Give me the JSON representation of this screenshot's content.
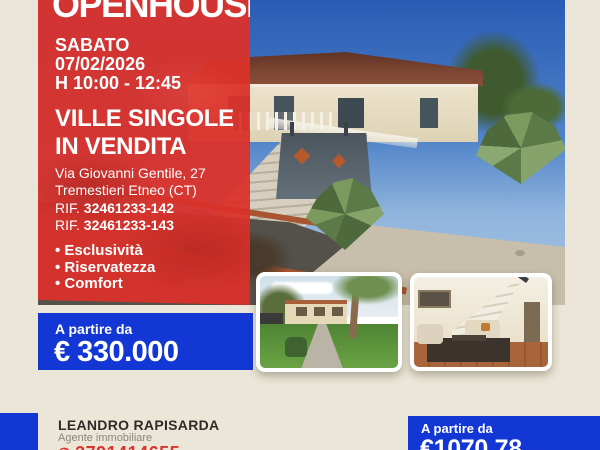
{
  "colors": {
    "accent_red": "#da352c",
    "accent_blue": "#1237d5",
    "background_cream": "#ebe6d7",
    "text_dark": "#2f2b27",
    "text_gray": "#8c8679"
  },
  "header": {
    "brand": "OPENHOUSE"
  },
  "event": {
    "day": "SABATO",
    "date": "07/02/2026",
    "time": "H 10:00 - 12:45"
  },
  "listing": {
    "title_line1": "VILLE SINGOLE",
    "title_line2": "IN VENDITA",
    "address_line1": "Via Giovanni Gentile, 27",
    "address_line2": "Tremestieri Etneo (CT)",
    "ref_label_1": "RIF.",
    "ref_value_1": "32461233-142",
    "ref_label_2": "RIF.",
    "ref_value_2": "32461233-143",
    "features": [
      "Esclusività",
      "Riservatezza",
      "Comfort"
    ]
  },
  "price_main": {
    "label": "A partire da",
    "value": "€ 330.000"
  },
  "price_secondary": {
    "label": "A partire da",
    "value": "€1070.78"
  },
  "agent": {
    "name": "LEANDRO RAPISARDA",
    "role": "Agente immobiliare",
    "phone": "3791414655",
    "phone_icon": "✆"
  },
  "photos": {
    "main": "villa exterior with staircase and agave garden",
    "thumb1": "garden and house exterior",
    "thumb2": "living room interior with staircase"
  }
}
